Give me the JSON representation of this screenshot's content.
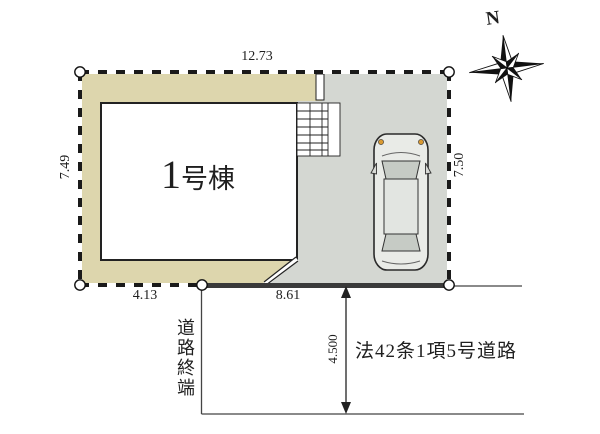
{
  "plan": {
    "building": {
      "label": "1号棟"
    },
    "compass": {
      "north_label": "N"
    },
    "dimensions": {
      "top": "12.73",
      "left": "7.49",
      "right": "7.50",
      "bottom_left": "4.13",
      "bottom_right": "8.61",
      "road_width": "4.500"
    },
    "road": {
      "terminus_label": "道路終端",
      "designation_label": "法42条1項5号道路"
    },
    "colors": {
      "lot": "#ddd6ad",
      "driveway": "#d4d7d2",
      "car_body": "#e9ebe7",
      "car_glass": "#c6cbc5",
      "headlight": "#d99a33",
      "line": "#1a1a1a"
    }
  }
}
